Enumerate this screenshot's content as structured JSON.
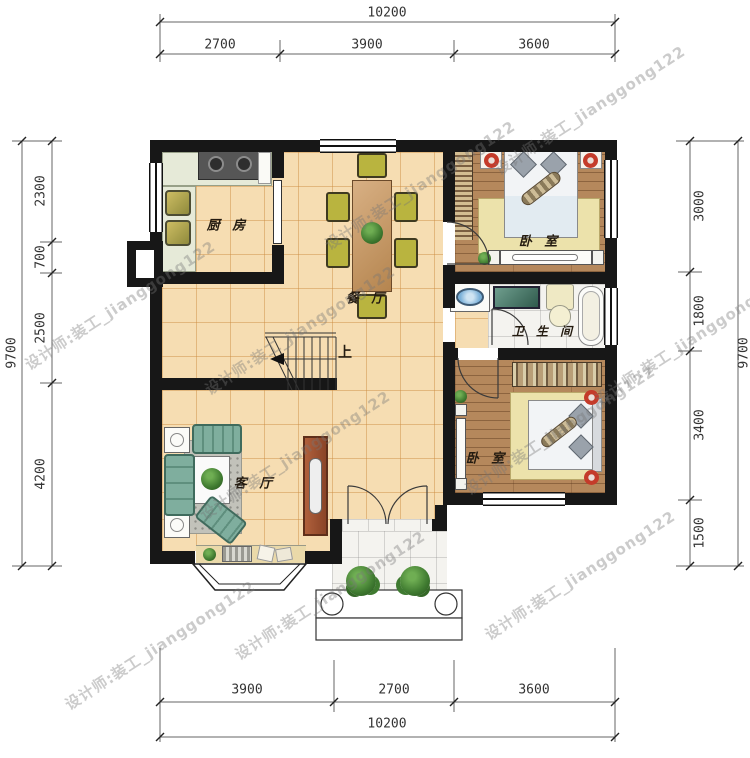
{
  "watermark": {
    "text": "设计师:装工_jianggong122"
  },
  "rooms": {
    "kitchen": "厨 房",
    "dining": "餐 厅",
    "bedroom_top": "卧 室",
    "bathroom": "卫 生 间",
    "living": "客 厅",
    "bedroom_bottom": "卧 室",
    "stairs_up": "上"
  },
  "dims": {
    "top": {
      "total": "10200",
      "segments": [
        "2700",
        "3900",
        "3600"
      ]
    },
    "bottom": {
      "total": "10200",
      "segments": [
        "3900",
        "2700",
        "3600"
      ]
    },
    "left": {
      "total": "9700",
      "segments": [
        "2300",
        "700",
        "2500",
        "4200"
      ]
    },
    "right": {
      "total": "9700",
      "segments": [
        "3000",
        "1800",
        "3400",
        "1500"
      ]
    }
  },
  "colors": {
    "wall": "#171717",
    "tile": "#f6ddb2",
    "wood": "#b5885c",
    "marble": "#f4f3ef",
    "lamp_red": "#c43b2a"
  }
}
